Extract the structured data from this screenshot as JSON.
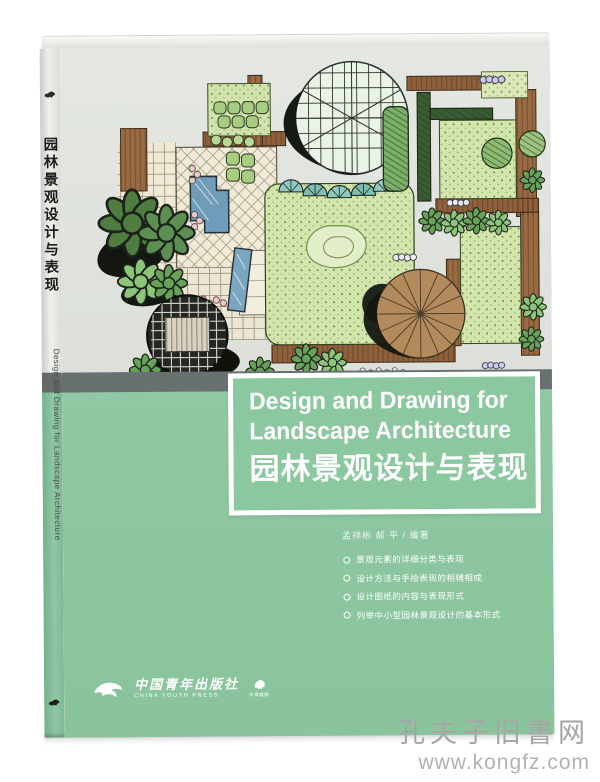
{
  "watermark": {
    "site_name": "孔夫子旧書网",
    "site_url": "www.kongfz.com"
  },
  "book": {
    "spine": {
      "title_cn": "园林景观设计与表现",
      "title_en": "Design and Drawing for Landscape Architecture"
    },
    "cover": {
      "title_en_line1": "Design and Drawing for",
      "title_en_line2": "Landscape Architecture",
      "title_cn": "园林景观设计与表现",
      "author_line": "孟祥彬  郝 平 / 编著",
      "selling_points": [
        "景观元素的详细分类与表现",
        "设计方法与手绘表现的相辅相成",
        "设计图纸的内容与表现形式",
        "列举中小型园林景观设计的基本形式"
      ],
      "publisher": {
        "name_cn": "中国青年出版社",
        "name_en": "CHINA YOUTH PRESS",
        "imprint": "中青雄狮"
      }
    },
    "colors": {
      "green": "#8fc8a2",
      "cover_gray": "#e1e4df",
      "band_gray": "#697070",
      "title_text": "#ffffff"
    }
  }
}
